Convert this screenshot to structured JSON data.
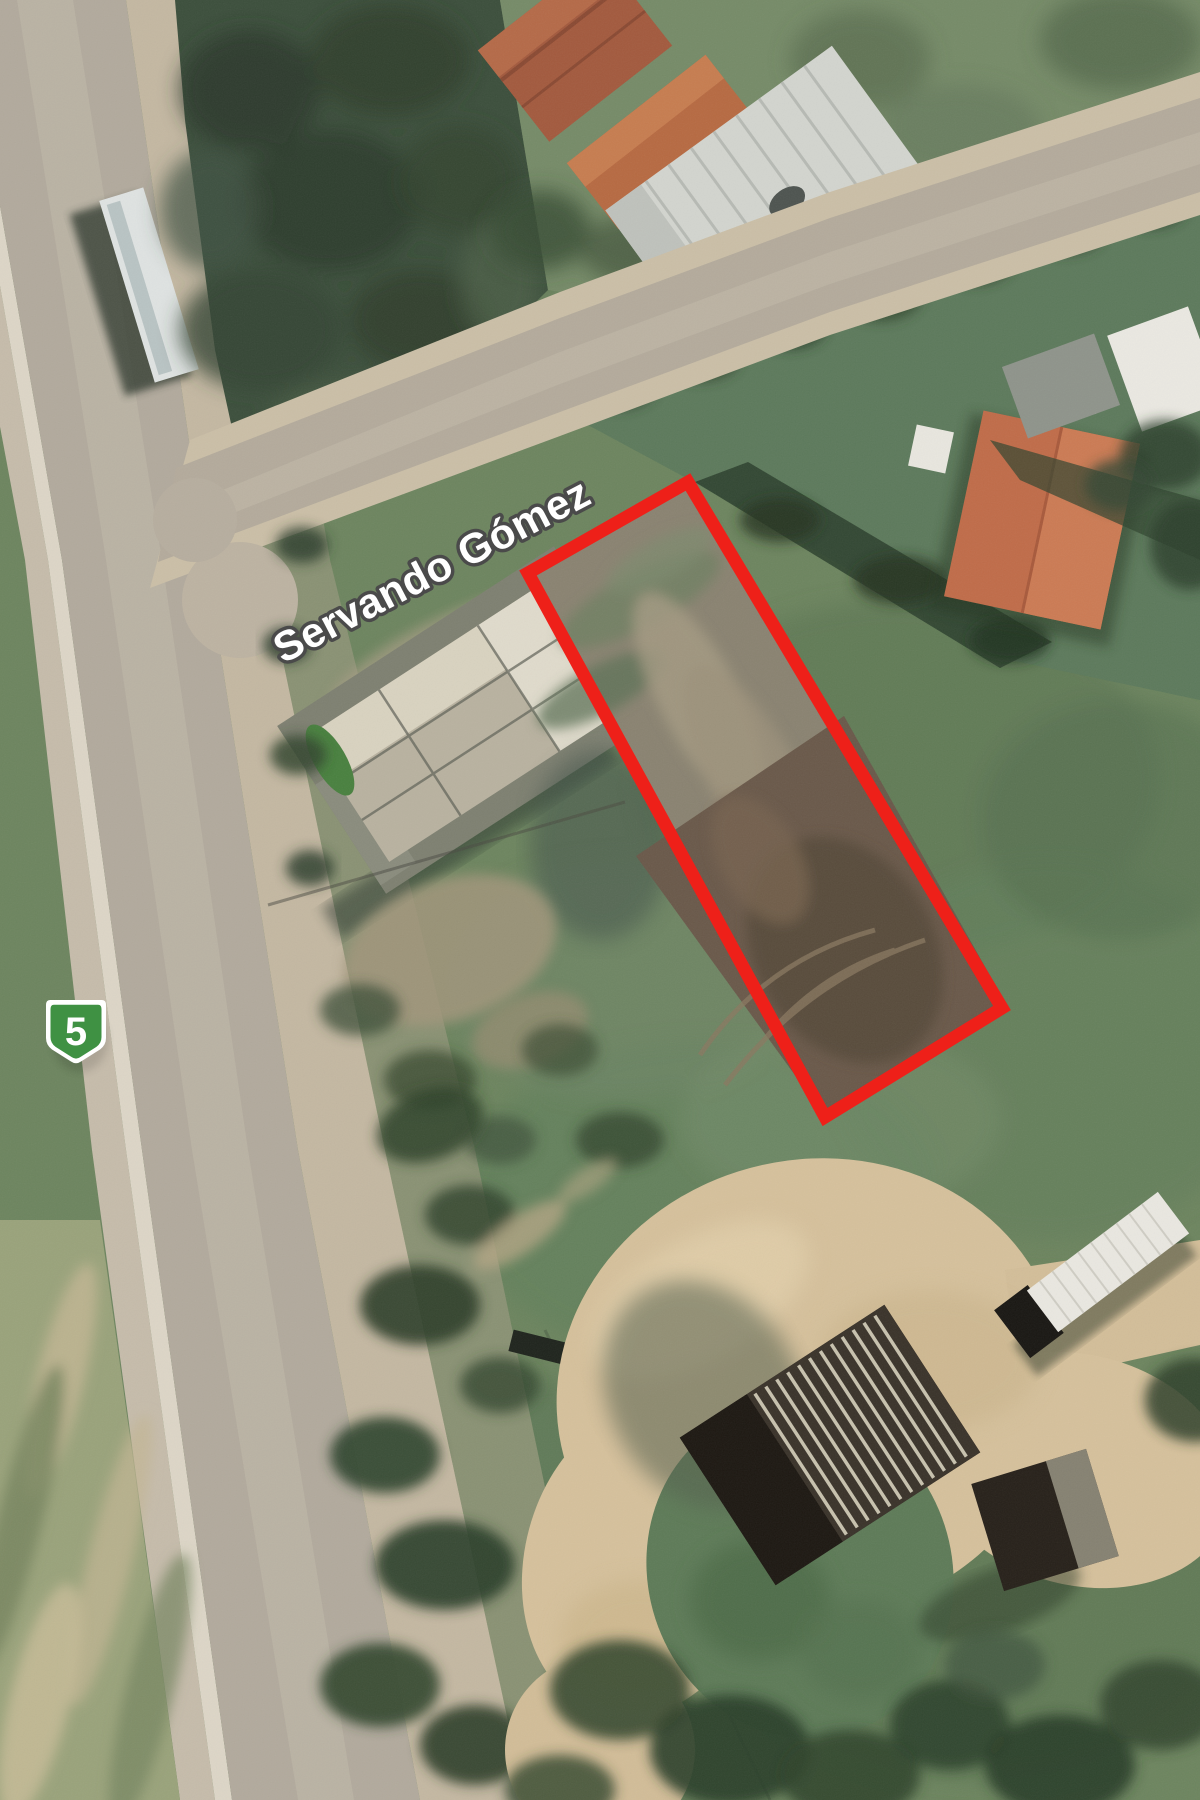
{
  "map": {
    "street_label": "Servando Gómez",
    "route_shield": {
      "label": "5",
      "fill": "#3f9143",
      "border": "#ffffff"
    },
    "plot_outline": {
      "points": "528,573 688,482 1002,1008 825,1117",
      "color": "#ee2019",
      "stroke_width": 13
    },
    "street_label_style": {
      "fill": "#ffffff",
      "outline": "#4a4a4a"
    }
  }
}
